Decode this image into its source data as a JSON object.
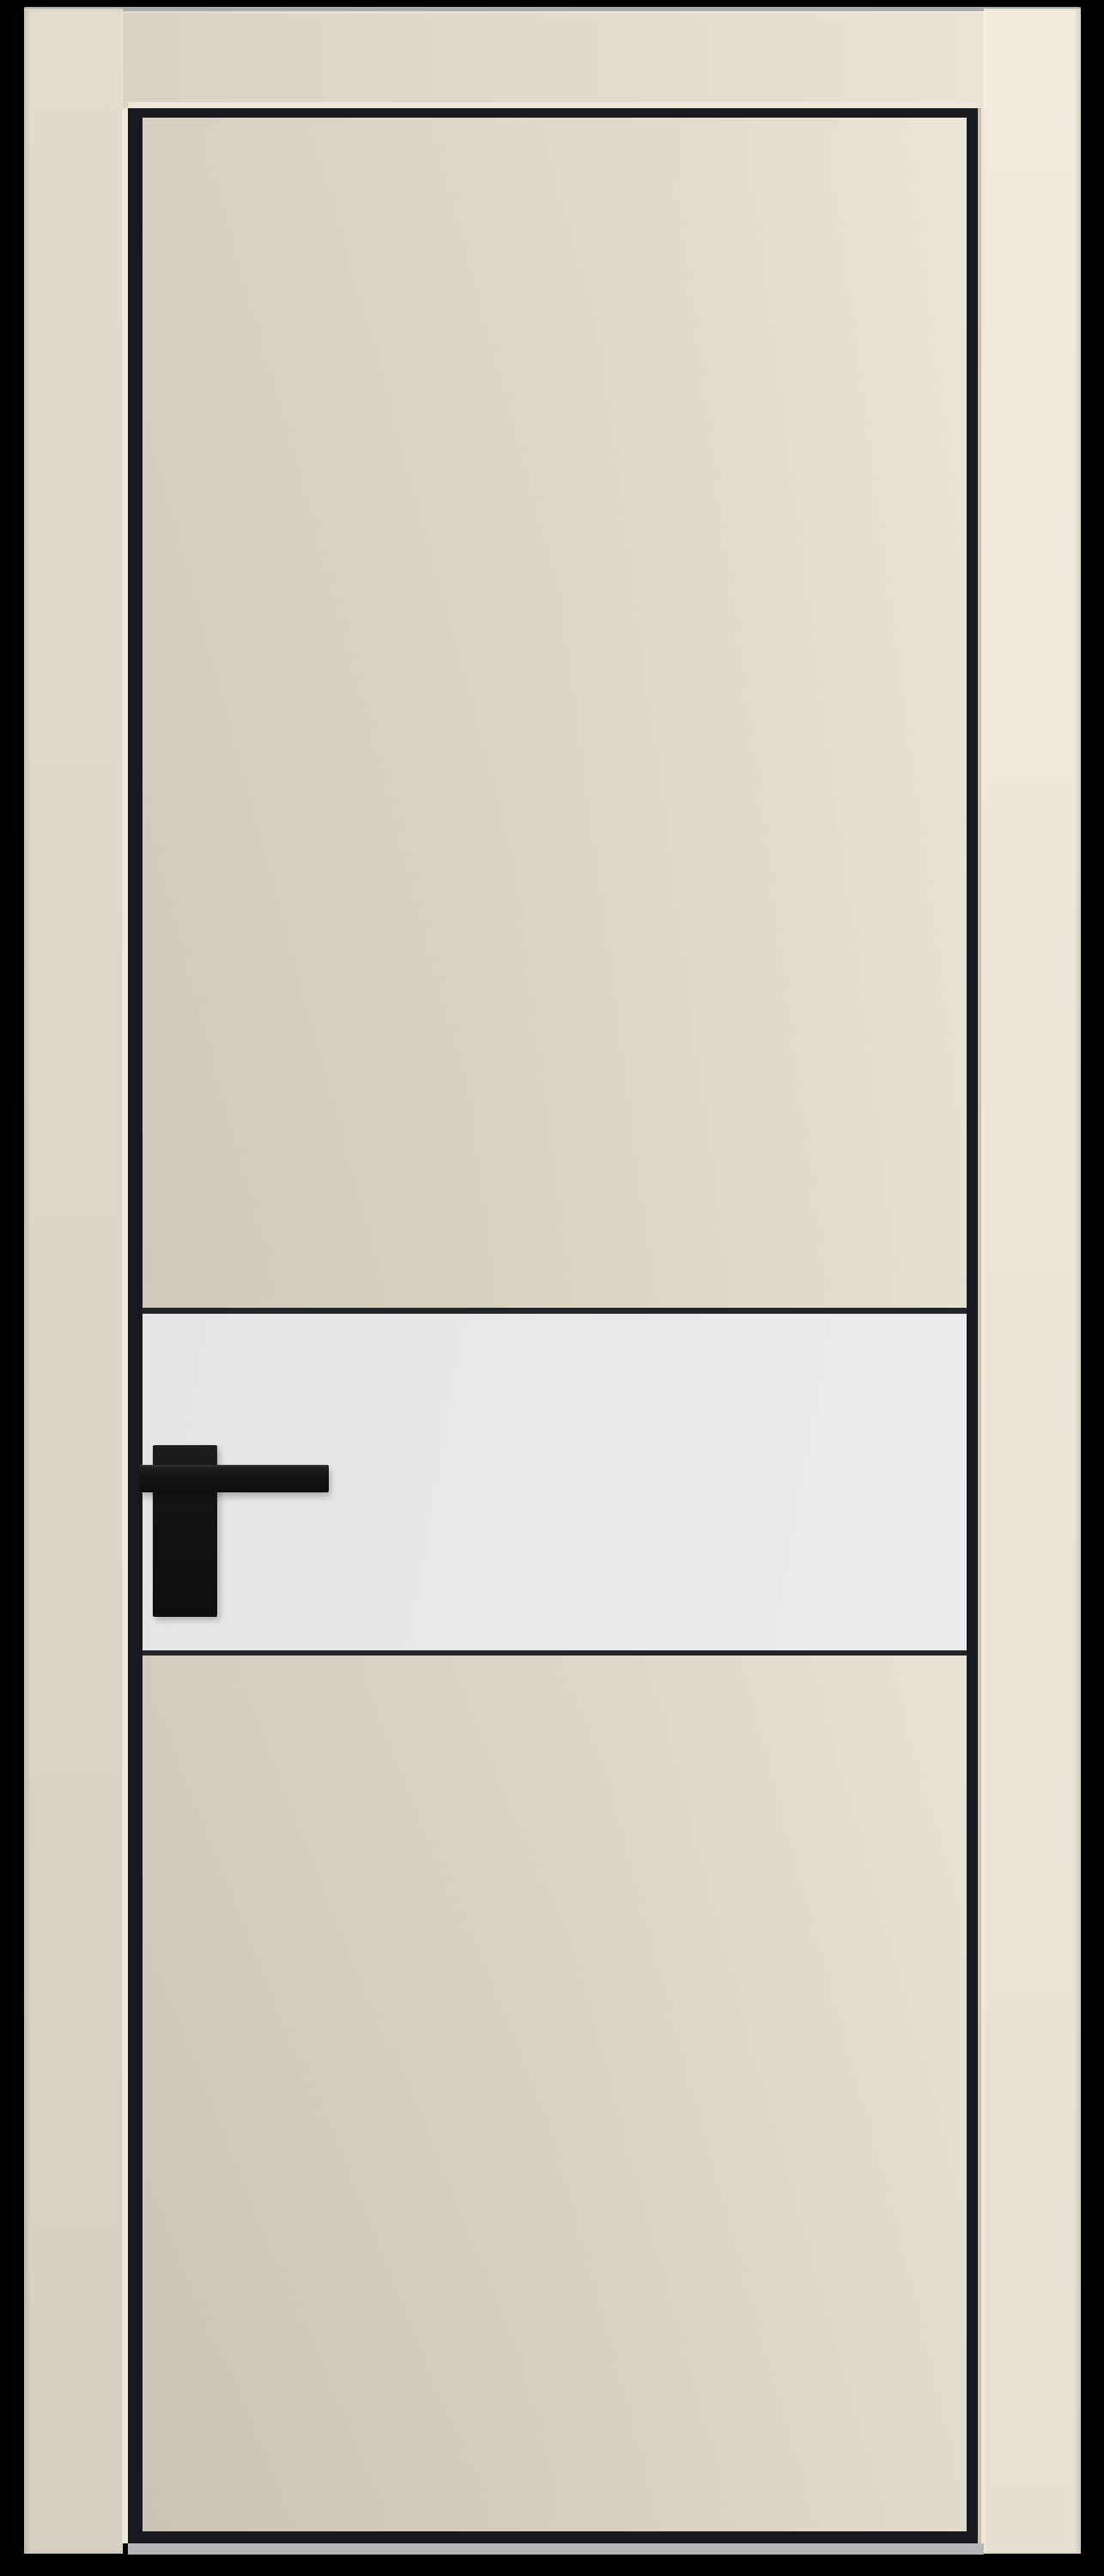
{
  "scene": {
    "type": "product-photo",
    "subject": "Tall cream interior door in a matching cream frame, with black aluminium edge trim, a white horizontal lacquered insert panel and a black square lever handle, photographed on a black background"
  },
  "colors": {
    "background": "#000000",
    "wall-top-line": "#c7c8ca",
    "header-left": "#d9d1c2",
    "header-right": "#eae2d3",
    "jamb-left-top": "#e3dbcc",
    "jamb-left-bottom": "#d7cfc1",
    "jamb-right-top": "#f2ebdc",
    "jamb-right-bottom": "#e7dfd0",
    "edge-highlight": "#efe8da",
    "edge-tan": "#cbbfaa",
    "trim-black": "#17191e",
    "separator": "#23252b",
    "leaf-upper-dark": "#d5cdbf",
    "leaf-upper-mid": "#e0d8c9",
    "leaf-upper-light": "#f1e9db",
    "leaf-lower-dark": "#d2cabc",
    "leaf-lower-mid": "#ded6c7",
    "leaf-lower-light": "#eee6d8",
    "insert-dark": "#e4e5e5",
    "insert-mid": "#e8e9e9",
    "insert-light": "#ebecec",
    "handle-black": "#141414",
    "floor-strip": "#b4b5b7"
  }
}
